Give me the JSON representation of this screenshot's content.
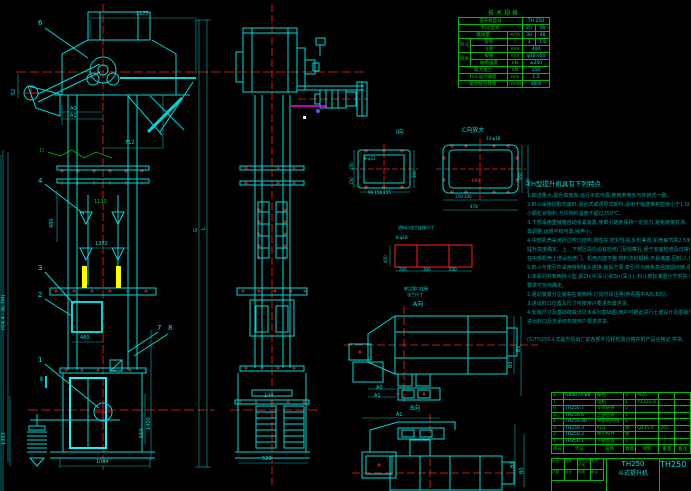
{
  "tech": {
    "title": "技术规格",
    "m_label": "提升机型号",
    "m_val": "TH 250",
    "bucket_label": "料斗型式",
    "bucket_v1": "Zh",
    "bucket_v2": "Sh",
    "cap_label": "输送量",
    "cap_unit": "m³/h",
    "cap_v1": "30",
    "cap_v2": "48",
    "g1": "料斗",
    "vol_label": "容积",
    "vol_unit": "l",
    "vol_v1": "3",
    "vol_v2": "1.6",
    "pitch_label": "斗距",
    "pitch_unit": "mm",
    "pitch_v": "400",
    "g2": "链条",
    "chain_label": "规格",
    "chain_unit": "mm",
    "chain_v": "φ18×64",
    "break_label": "破断强度",
    "break_unit": "kN",
    "break_v": "≥250",
    "tension_label": "最大张力",
    "tension_unit": "kN",
    "tension_v": "250",
    "speed_label": "料斗运行速度",
    "speed_unit": "m/s",
    "speed_v": "1.2",
    "rpm_label": "驱动链轮转速",
    "rpm_unit": "r/min",
    "rpm_v": "48.8"
  },
  "notes": {
    "heading": "TH型提升机具有下列特点",
    "lines": [
      "1.输送量大,提升高度高,运行平稳可靠,使用寿命长与环链式一致。",
      "2.料斗采用挖取式装料,混合式或诱导式卸料,适用于输送堆积密度小于1.5t/m³的一般粉状及",
      "  小颗粒状物料,允许物料温度不超过250℃。",
      "3.下部采用重锤箱自动张紧装置,使牵引链条保持一定张力,避免链条打滑、脱链,一般情况下无",
      "  需调整,运转平稳可靠,噪声小。",
      "4.中部机壳采用折边咬口结构,刚性好,密封性强,外形美观;机壳每节高2.5米,中部机壳数量按",
      "  提升高度确定。上、下部区段均设有检修门及观察孔,便于安装检修及日常维护,若需要时可",
      "  在中部机壳上增设检修门。机壳内壁平整,物料流动顺畅,不易堵塞,回料少,提升效率高。",
      "5.料斗与牵引件采用特制接头连接,装拆方便,牵引件为两条高强度圆环链,强度高,耐磨性好。",
      "1.本系列共有两种斗型,即Zh(中深斗)和Sh(深斗),          料斗按标准图分节供货,特殊",
      "  要求可协商确定。",
      "2.驱动装置分左装和右装两种,订货时请注明(参看图中A向,B向)。",
      "3.进出料口位置及尺寸可按用户要求布置供货。",
      "4.安装尺寸及基础荷载详见本系列基础图,用户可据此进行土建设计及基础施工,并以Y,Z系列",
      "  进出料口及支承结构按用户要求供货。",
      "",
      "(5)TH250斗式提升机出厂前各部件均经检验合格并附产品合格证 供货。"
    ]
  },
  "parts": {
    "headers": [
      "序号",
      "代号",
      "名称",
      "数量",
      "材料",
      "重量",
      "备注"
    ],
    "rows": [
      {
        "no": "8",
        "code": "GB9074-88",
        "name": "螺栓",
        "qty": "4",
        "mat": "M20",
        "wt": ""
      },
      {
        "no": "7",
        "code": "",
        "name": "电机",
        "qty": "1",
        "mat": "Y132S-4",
        "wt": ""
      },
      {
        "no": "6",
        "code": "TH250.7",
        "name": "斗式链条",
        "qty": "2",
        "mat": "",
        "wt": ""
      },
      {
        "no": "5",
        "code": "TH250.6",
        "name": "上部区段",
        "qty": "1",
        "mat": "",
        "wt": ""
      },
      {
        "no": "4",
        "code": "TH250.4B",
        "name": "中部机壳组",
        "qty": "1",
        "mat": "",
        "wt": ""
      },
      {
        "no": "3",
        "code": "TH250.3",
        "name": "料斗",
        "qty": "组",
        "mat": "Q235-A",
        "wt": "205"
      },
      {
        "no": "2",
        "code": "TH250.2",
        "name": "牵引构件",
        "qty": "组",
        "mat": "",
        "wt": ""
      },
      {
        "no": "1",
        "code": "TH250.1",
        "name": "下部区段",
        "qty": "1",
        "mat": "",
        "wt": ""
      }
    ]
  },
  "titleblock": {
    "model": "TH250",
    "name": "斗式提升机",
    "drawing_no": "TH250",
    "small_labels": [
      "标记",
      "处数",
      "更改文件号",
      "签名",
      "日期",
      "设计",
      "校核",
      "审定"
    ]
  },
  "views": {
    "i": "Ⅰ向",
    "c": "C向放大",
    "a": "A向",
    "b": "B向",
    "flange_title": "进料口法兰连接尺寸",
    "dust1": "收尘管口连接",
    "dust2": "法兰尺寸"
  },
  "balloons": {
    "n1": "1",
    "n2": "2",
    "n3": "3",
    "n4": "4",
    "n6": "6",
    "n7": "7",
    "n8": "8"
  },
  "dims": {
    "top_width": "1173",
    "head_out": "712",
    "a0": "A0",
    "a1": "A1",
    "left_small": "52",
    "mid_green": "1130",
    "mid_width": "1382",
    "mid_v": "480",
    "boot_w": "480",
    "right_total": "1400",
    "right_low": "550",
    "left_total": "1333",
    "bottom_w": "1044",
    "g": "G",
    "l": "L",
    "height_note": "H(4.4~36.7M)",
    "sec2": "Ⅱ",
    "green_d": "D",
    "side_gap": "144",
    "side_boot": "520",
    "i_l1": "150",
    "i_l2": "150",
    "i_r": "300",
    "i_b": "99 158 155",
    "i_holes": "8-φ12",
    "c_holes": "13-φ18",
    "c_center": "660",
    "c_r1": "350",
    "c_r2": "420",
    "c_b1": "150 300",
    "c_b2": "478",
    "f_holes": "8-φ18",
    "f_left": "450",
    "f_b1": "200",
    "f_b2": "300",
    "f_b3": "200",
    "a_b0": "B0",
    "a_b1": "B1",
    "a_a0": "A0",
    "a_a1": "A1",
    "b_a1": "A1",
    "b_b0": "B0",
    "b_b1": "B1"
  }
}
